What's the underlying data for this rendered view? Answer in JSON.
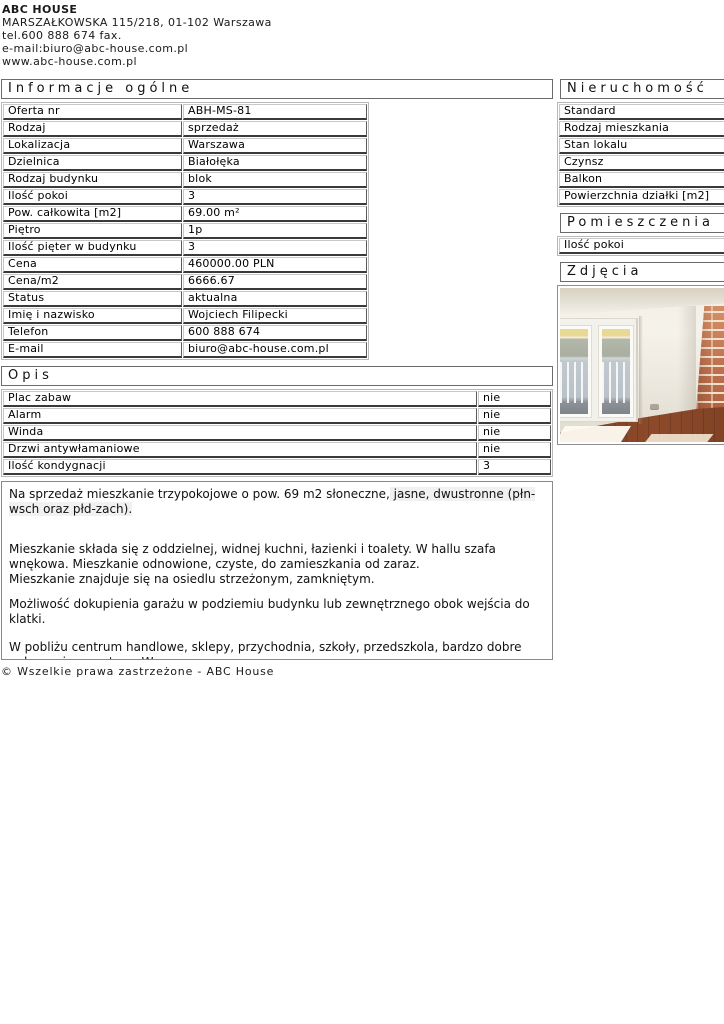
{
  "colors": {
    "highlight_bg": "#f1f1f1",
    "floor_brown": "#7e3f24",
    "brick": "#c4754e"
  },
  "company": {
    "name": "ABC HOUSE",
    "address": "MARSZAŁKOWSKA 115/218, 01-102 Warszawa",
    "phone_fax": "tel.600 888 674 fax.",
    "email": "e-mail:biuro@abc-house.com.pl",
    "website": "www.abc-house.com.pl"
  },
  "general_info": {
    "title": "Informacje ogólne",
    "rows": [
      {
        "label": "Oferta nr",
        "value": "ABH-MS-81"
      },
      {
        "label": "Rodzaj",
        "value": "sprzedaż"
      },
      {
        "label": "Lokalizacja",
        "value": "Warszawa"
      },
      {
        "label": "Dzielnica",
        "value": "Białołęka"
      },
      {
        "label": "Rodzaj budynku",
        "value": "blok"
      },
      {
        "label": "Ilość pokoi",
        "value": "3"
      },
      {
        "label": "Pow. całkowita [m2]",
        "value": "69.00 m²"
      },
      {
        "label": "Piętro",
        "value": "1p"
      },
      {
        "label": "Ilość pięter w budynku",
        "value": "3"
      },
      {
        "label": "Cena",
        "value": "460000.00 PLN"
      },
      {
        "label": "Cena/m2",
        "value": "6666.67"
      },
      {
        "label": "Status",
        "value": "aktualna"
      },
      {
        "label": "Imię i nazwisko",
        "value": "Wojciech Filipecki"
      },
      {
        "label": "Telefon",
        "value": "600 888 674"
      },
      {
        "label": "E-mail",
        "value": "biuro@abc-house.com.pl"
      }
    ]
  },
  "opis": {
    "title": "Opis",
    "rows": [
      {
        "label": "Plac zabaw",
        "value": "nie"
      },
      {
        "label": "Alarm",
        "value": "nie"
      },
      {
        "label": "Winda",
        "value": "nie"
      },
      {
        "label": "Drzwi antywłamaniowe",
        "value": "nie"
      },
      {
        "label": "Ilość kondygnacji",
        "value": "3"
      }
    ],
    "paragraphs": {
      "p1_normal": "Na sprzedaż mieszkanie trzypokojowe o pow. 69 m2 słoneczne,",
      "p1_highlight": " jasne, dwustronne (płn-wsch oraz płd-zach).",
      "p2_line1": "Mieszkanie składa się z oddzielnej, widnej kuchni, łazienki i toalety. W hallu szafa wnękowa. Mieszkanie odnowione, czyste, do zamieszkania od zaraz.",
      "p2_line2": "Mieszkanie znajduje się na osiedlu strzeżonym, zamkniętym.",
      "p3": "Możliwość dokupienia garażu w podziemiu budynku lub zewnętrznego obok wejścia do klatki.",
      "p4": "W pobliżu centrum handlowe, sklepy, przychodnia, szkoły, przedszkola, bardzo dobre połączenie z centrum Warszawy."
    }
  },
  "sidebar": {
    "nieruchomosc": {
      "title": "Nieruchomość",
      "rows": [
        "Standard",
        "Rodzaj mieszkania",
        "Stan lokalu",
        "Czynsz",
        "Balkon",
        "Powierzchnia działki [m2]"
      ]
    },
    "pomieszczenia": {
      "title": "Pomieszczenia",
      "rows": [
        "Ilość pokoi"
      ]
    },
    "zdjecia": {
      "title": "Zdjęcia"
    }
  },
  "footer": {
    "copyright": "© Wszelkie prawa zastrzeżone - ABC House"
  }
}
